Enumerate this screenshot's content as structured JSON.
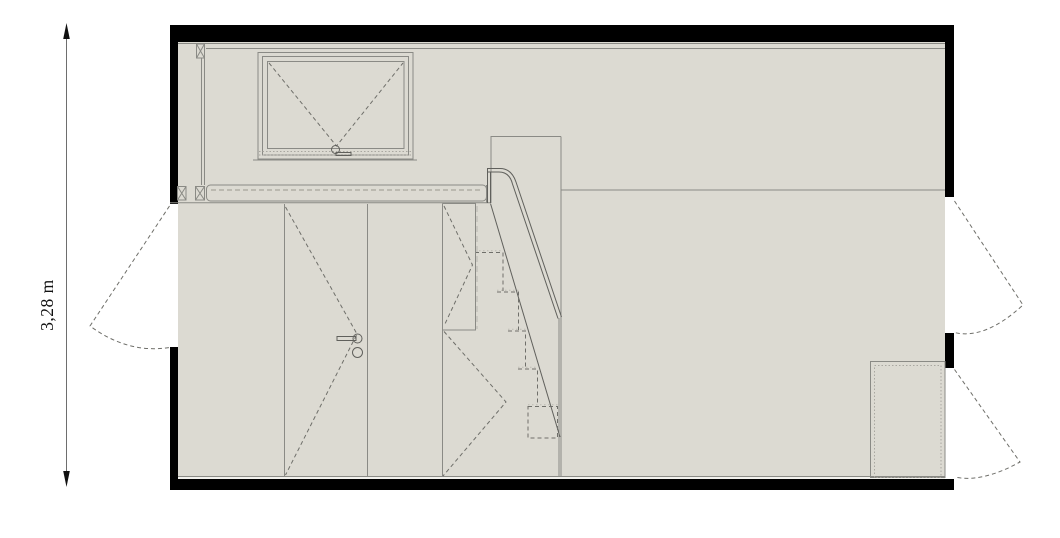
{
  "dimension": {
    "height_label": "3,28 m"
  },
  "colors": {
    "wall": "#000000",
    "interior_fill": "#dcdad2",
    "band_fill": "#e2e0d8",
    "line": "#8a8a85",
    "line_dark": "#60605c",
    "dash": "#6f6f6a",
    "dot": "#a9a7a0",
    "background": "#ffffff",
    "dimension_text": "#111111"
  }
}
